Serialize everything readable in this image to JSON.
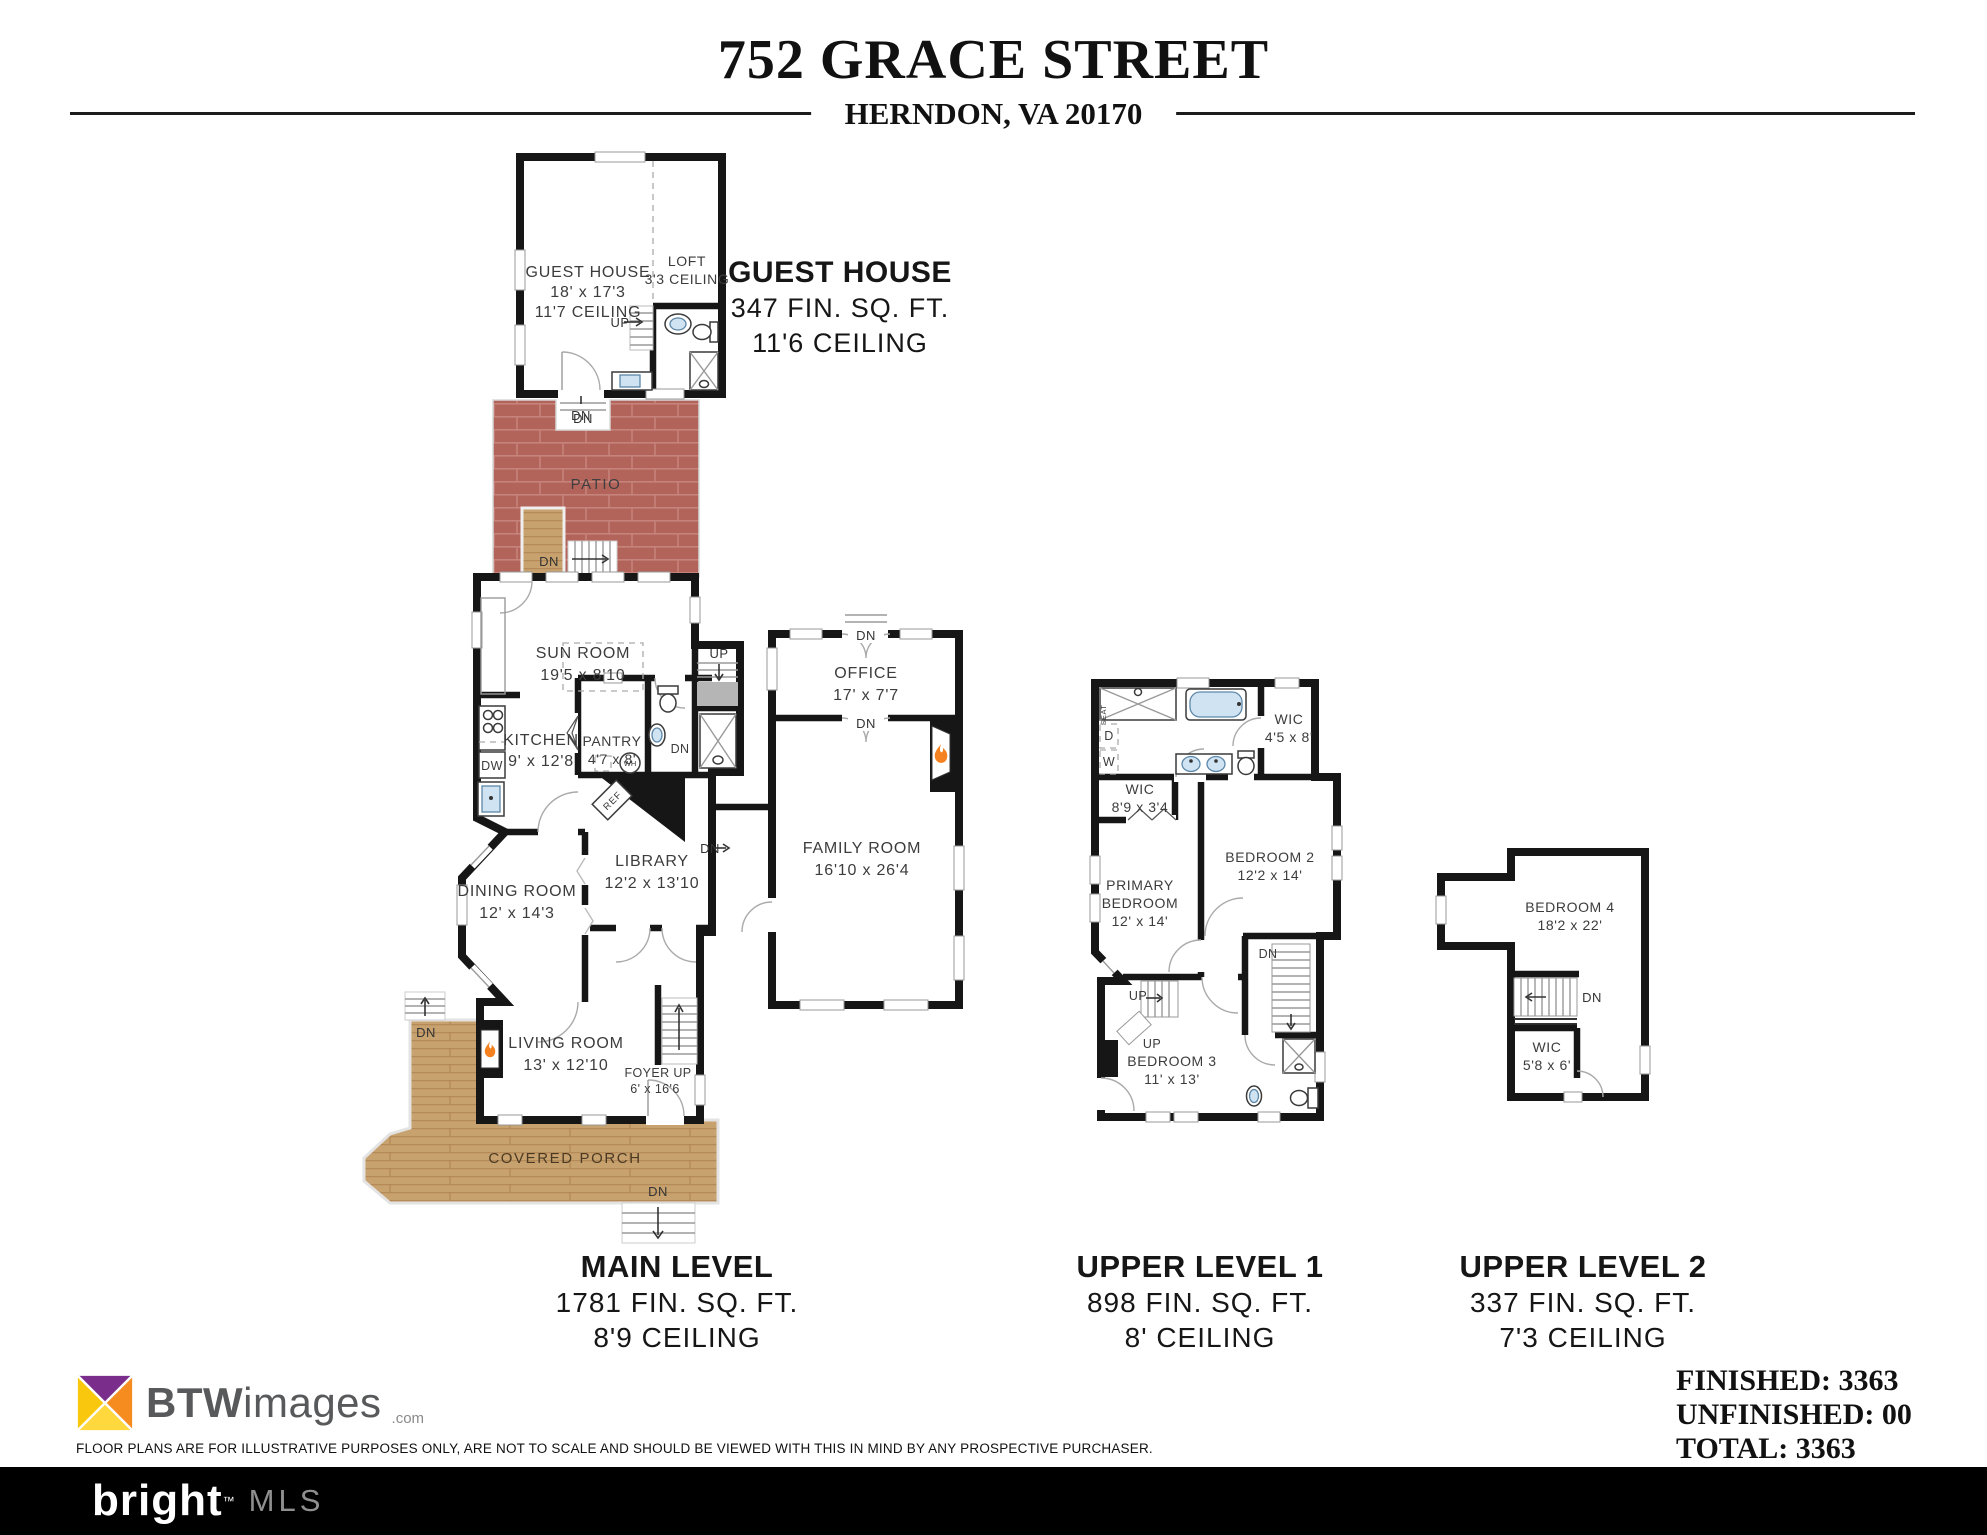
{
  "header": {
    "address": "752 GRACE STREET",
    "city_line": "HERNDON, VA 20170"
  },
  "guest_house_heading": {
    "title": "GUEST HOUSE",
    "sqft": "347 FIN. SQ. FT.",
    "ceiling": "11'6 CEILING"
  },
  "levels": [
    {
      "name": "MAIN LEVEL",
      "sqft": "1781 FIN. SQ. FT.",
      "ceiling": "8'9 CEILING"
    },
    {
      "name": "UPPER LEVEL 1",
      "sqft": "898 FIN. SQ. FT.",
      "ceiling": "8' CEILING"
    },
    {
      "name": "UPPER LEVEL 2",
      "sqft": "337 FIN. SQ. FT.",
      "ceiling": "7'3 CEILING"
    }
  ],
  "totals": {
    "finished": "FINISHED: 3363",
    "unfinished": "UNFINISHED: 00",
    "total": "TOTAL: 3363"
  },
  "rooms": {
    "guest_house": {
      "name": "GUEST HOUSE",
      "dim": "18' x 17'3",
      "ceiling": "11'7 CEILING"
    },
    "loft": {
      "name": "LOFT",
      "ceiling": "3'3 CEILING"
    },
    "patio": {
      "name": "PATIO"
    },
    "sun_room": {
      "name": "SUN ROOM",
      "dim": "19'5 x 8'10"
    },
    "kitchen": {
      "name": "KITCHEN",
      "dim": "9' x 12'8"
    },
    "pantry": {
      "name": "PANTRY",
      "dim": "4'7 x 8'"
    },
    "office": {
      "name": "OFFICE",
      "dim": "17' x 7'7"
    },
    "library": {
      "name": "LIBRARY",
      "dim": "12'2 x 13'10"
    },
    "family_room": {
      "name": "FAMILY ROOM",
      "dim": "16'10 x 26'4"
    },
    "dining_room": {
      "name": "DINING ROOM",
      "dim": "12' x 14'3"
    },
    "living_room": {
      "name": "LIVING ROOM",
      "dim": "13' x 12'10"
    },
    "foyer": {
      "name": "FOYER  UP",
      "dim": "6' x 16'6"
    },
    "covered_porch": {
      "name": "COVERED PORCH"
    },
    "wic_bath": {
      "name": "WIC",
      "dim": "4'5 x 8'"
    },
    "wic_primary": {
      "name": "WIC",
      "dim": "8'9 x 3'4"
    },
    "primary_bedroom": {
      "name1": "PRIMARY",
      "name2": "BEDROOM",
      "dim": "12' x 14'"
    },
    "bedroom2": {
      "name": "BEDROOM 2",
      "dim": "12'2 x 14'"
    },
    "bedroom3": {
      "name": "BEDROOM 3",
      "dim": "11' x 13'"
    },
    "bedroom4": {
      "name": "BEDROOM 4",
      "dim": "18'2 x 22'"
    },
    "wic_upper2": {
      "name": "WIC",
      "dim": "5'8 x 6'"
    }
  },
  "glyphs": {
    "up": "UP",
    "dn": "DN",
    "dw": "DW",
    "wh": "WH",
    "ref": "REF",
    "seat": "SEAT",
    "d": "D",
    "w": "W"
  },
  "footer": {
    "logo_bold": "BTW",
    "logo_rest": "images",
    "logo_suffix": ".com",
    "disclaimer": "FLOOR PLANS ARE FOR ILLUSTRATIVE PURPOSES ONLY, ARE NOT TO SCALE AND SHOULD BE VIEWED WITH THIS IN MIND BY ANY PROSPECTIVE PURCHASER.",
    "brand": "bright",
    "brand_tm": "™",
    "brand_mls": "MLS"
  },
  "colors": {
    "patio_brick": "#b2635a",
    "porch_wood": "#c8a26e",
    "wall": "#161616",
    "fixture_blue": "#cfe3f2",
    "flame_orange": "#f5821f"
  }
}
